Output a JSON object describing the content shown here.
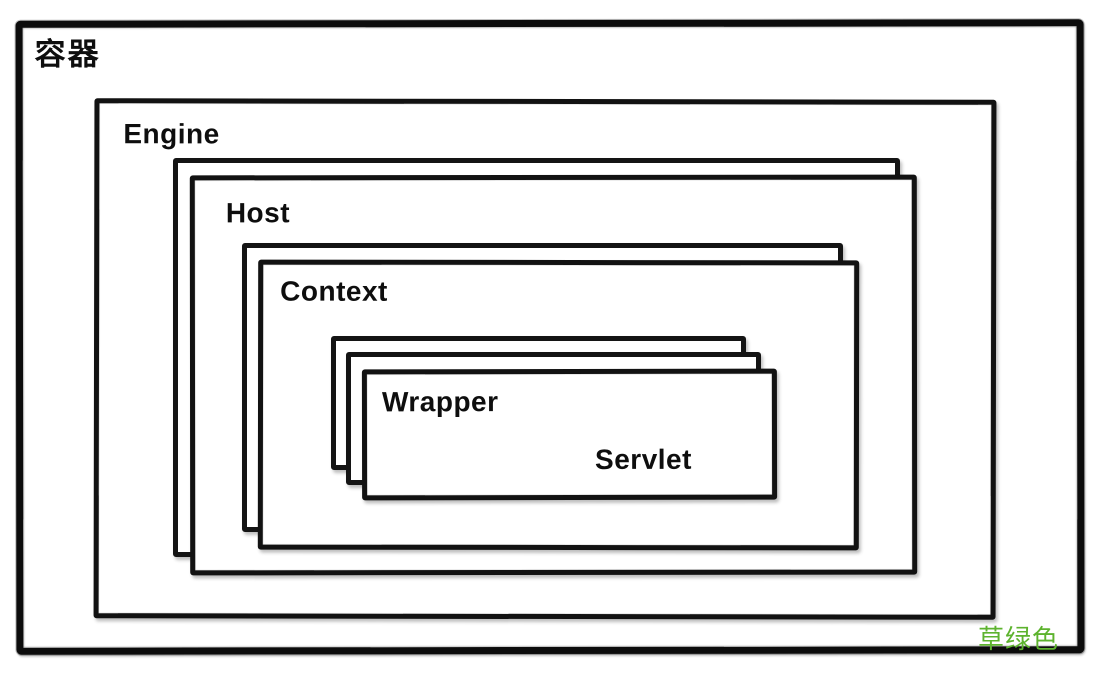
{
  "diagram": {
    "type": "nested-container-architecture",
    "nodes": {
      "container": {
        "label": "容器",
        "stacked_layers": 1
      },
      "engine": {
        "label": "Engine",
        "stacked_layers": 1
      },
      "host": {
        "label": "Host",
        "stacked_layers": 2
      },
      "context": {
        "label": "Context",
        "stacked_layers": 2
      },
      "wrapper": {
        "label": "Wrapper",
        "stacked_layers": 3
      },
      "servlet": {
        "label": "Servlet"
      }
    },
    "annotation": {
      "text": "草绿色",
      "color": "#5db32e"
    },
    "palette": {
      "ink": "#121212",
      "background": "#ffffff"
    }
  }
}
